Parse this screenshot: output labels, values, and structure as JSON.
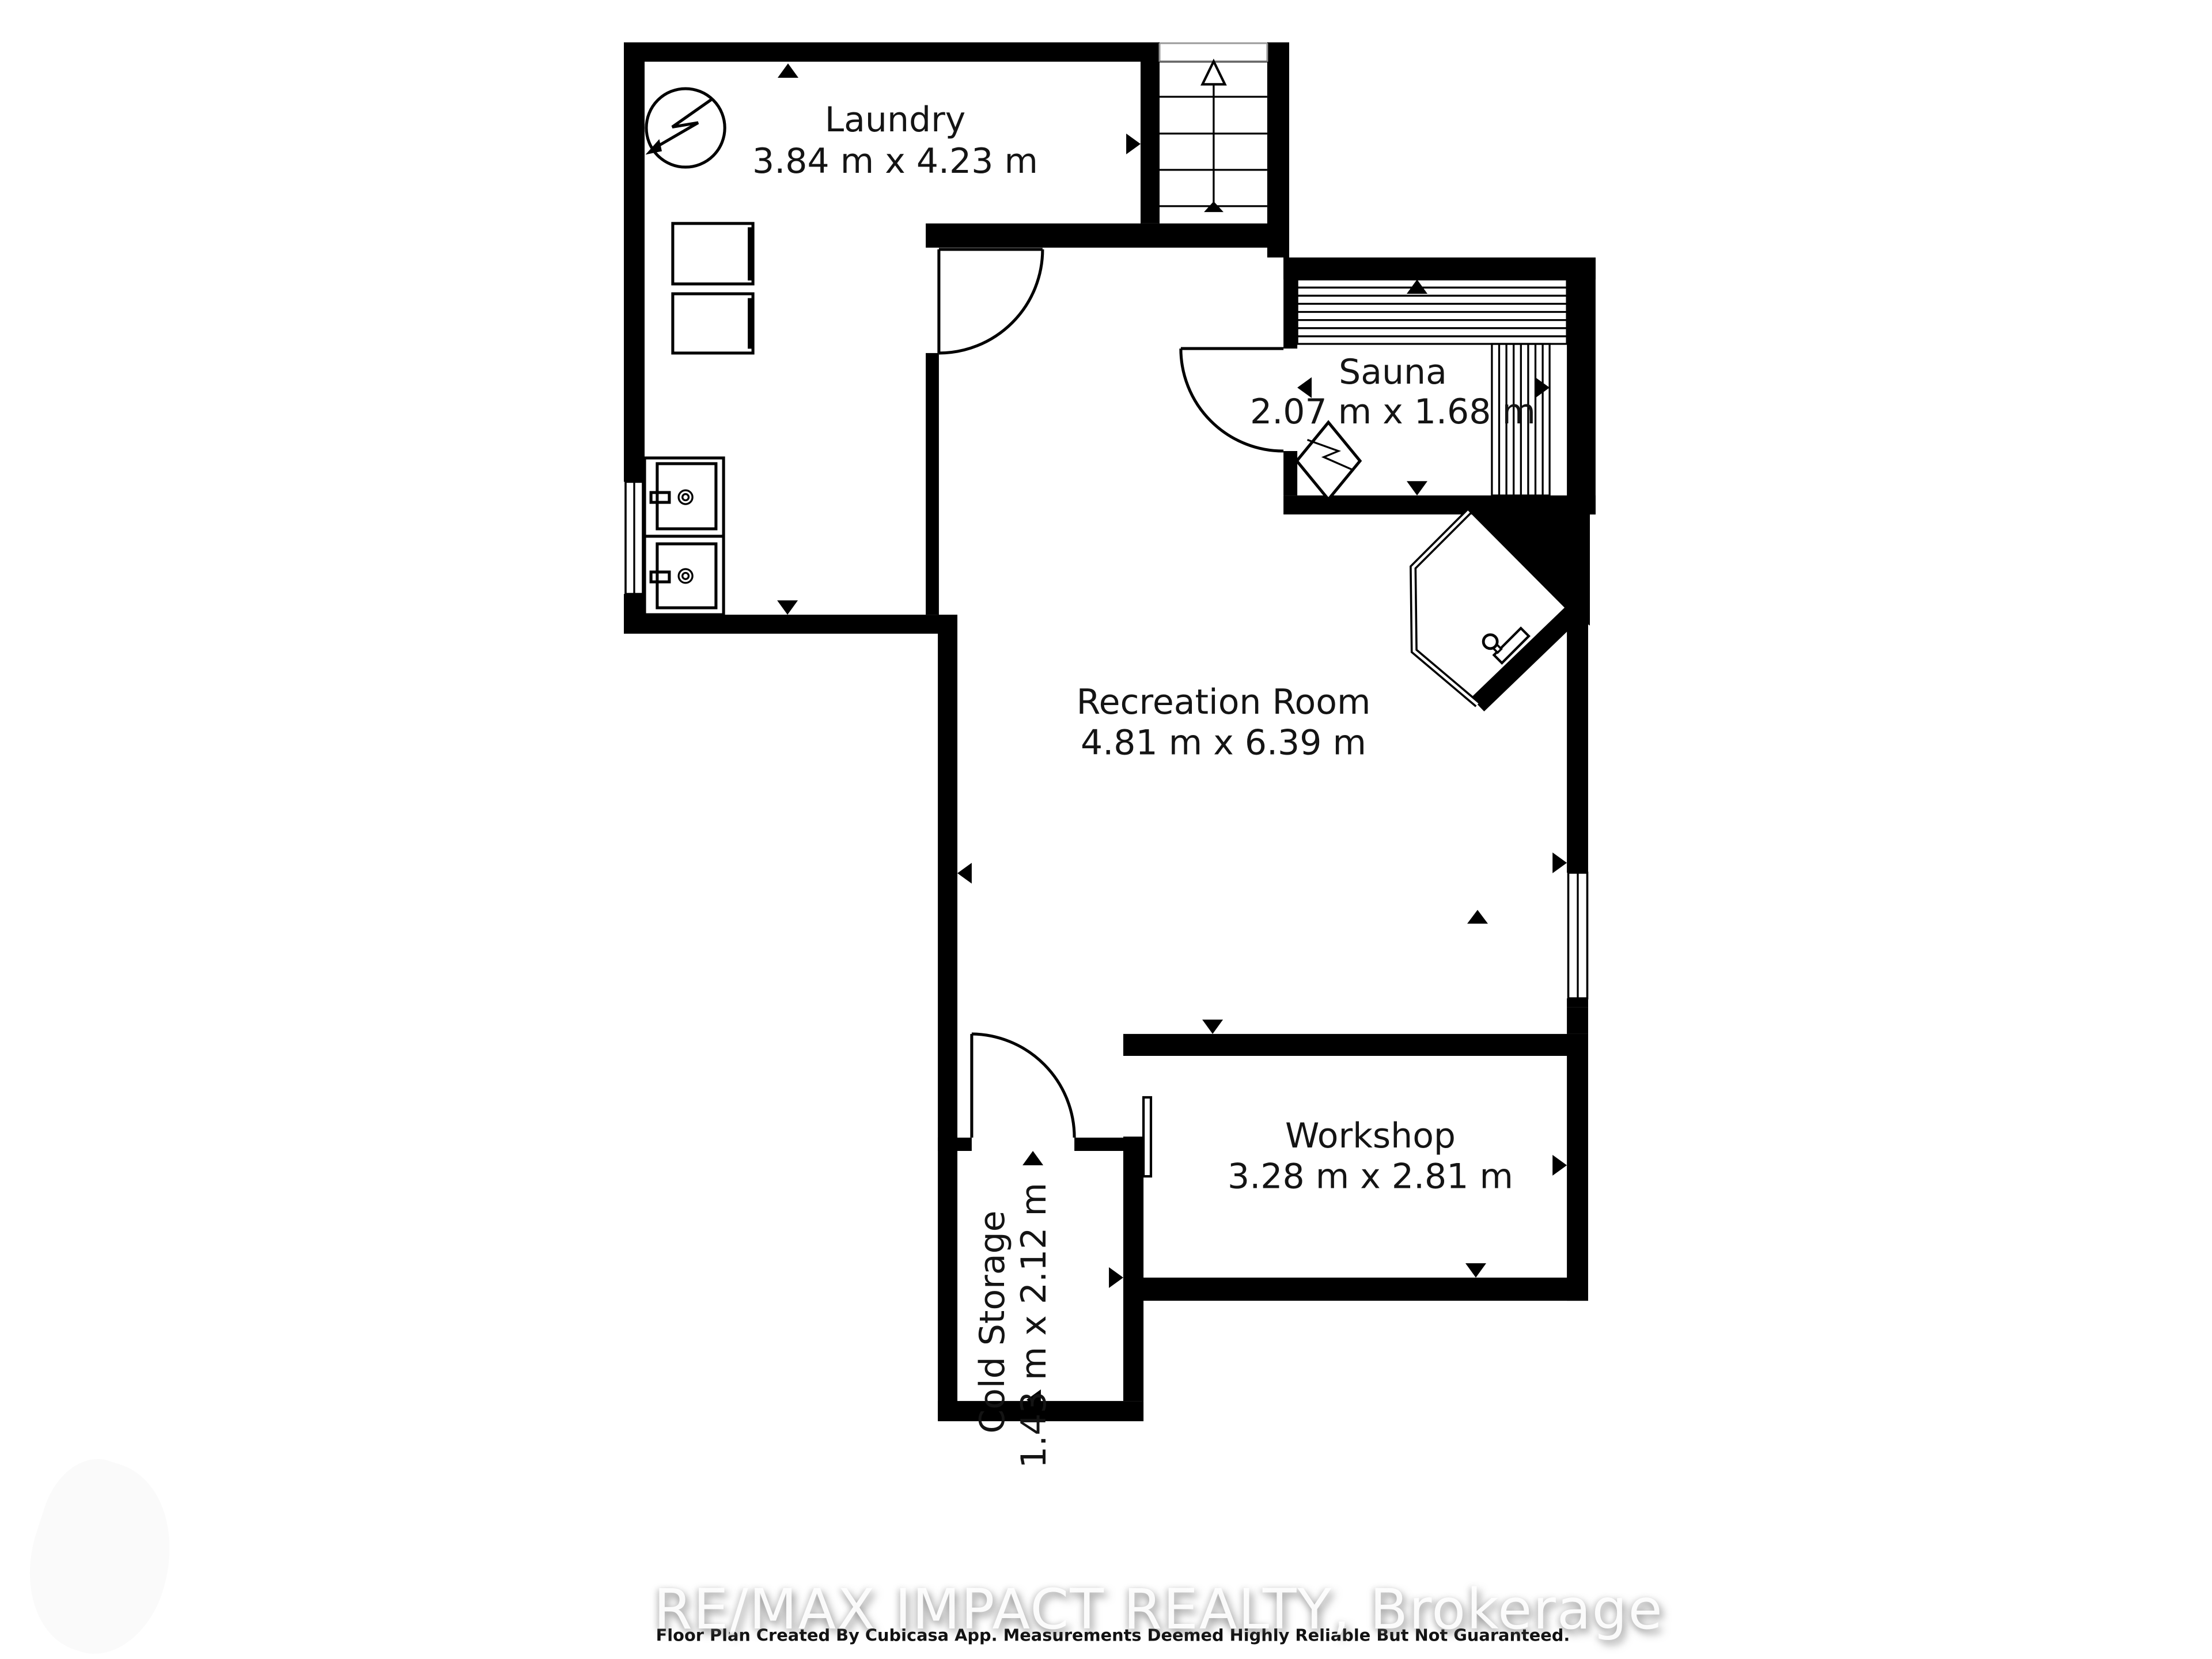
{
  "floor_plan": {
    "title": "Basement floor plan",
    "rooms": [
      {
        "id": "laundry",
        "name": "Laundry",
        "dimensions": "3.84 m x 4.23 m"
      },
      {
        "id": "sauna",
        "name": "Sauna",
        "dimensions": "2.07 m x 1.68 m"
      },
      {
        "id": "recreation",
        "name": "Recreation Room",
        "dimensions": "4.81 m x 6.39 m"
      },
      {
        "id": "workshop",
        "name": "Workshop",
        "dimensions": "3.28 m x 2.81 m"
      },
      {
        "id": "cold_storage",
        "name": "Cold Storage",
        "dimensions": "1.43 m x 2.12 m"
      }
    ],
    "staircase": {
      "arrow_direction": "up"
    },
    "icons": [
      "water-heater-icon",
      "washer-icon",
      "dryer-icon",
      "laundry-double-sink-icon",
      "staircase-up-icon",
      "door-swing-icon",
      "sauna-bench-icon",
      "sauna-heater-icon",
      "corner-shower-icon",
      "window-icon",
      "measurement-arrow-icon"
    ],
    "colors": {
      "walls": "#000000",
      "background": "#ffffff",
      "stair_detail": "#9a9a9a"
    }
  },
  "footer": {
    "disclaimer": "Floor Plan Created By Cubicasa App. Measurements Deemed Highly Reliable But Not Guaranteed."
  },
  "watermark": {
    "text": "RE/MAX IMPACT REALTY, Brokerage"
  }
}
